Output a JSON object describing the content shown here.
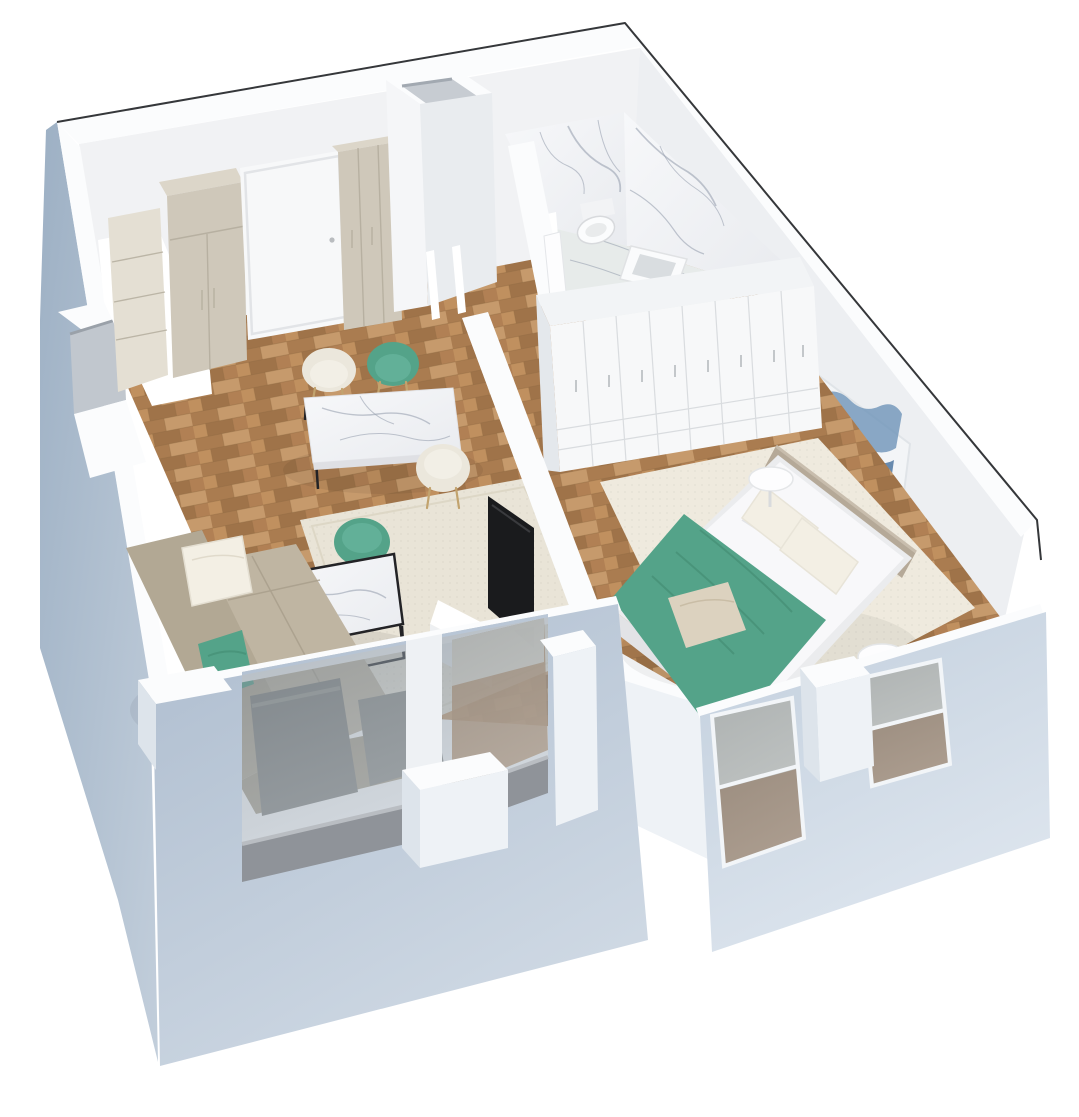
{
  "scene": {
    "title": "3D isometric cutaway floor plan of a one-bedroom apartment",
    "view": "bird's-eye axonometric render, walls cut open, exterior walls blue-grey",
    "rooms": [
      {
        "name": "living-dining-room",
        "floor": "wood-parquet",
        "items": [
          "beige-corner-sofa",
          "white-throw-pillow",
          "green-throw-pillow",
          "beige-area-rug",
          "marble-coffee-table-black-frame",
          "marble-dining-table",
          "green-dining-chair",
          "green-dining-chair-2",
          "beige-dining-chair",
          "beige-dining-chair-2",
          "tv-on-wall",
          "white-media-unit",
          "beige-kitchen-shelving",
          "beige-tall-cabinet",
          "beige-tall-cabinet-2",
          "white-entrance-door",
          "white-counter-block",
          "two-large-front-windows"
        ]
      },
      {
        "name": "hallway",
        "floor": "wood-parquet",
        "items": [
          "vent-shaft-column",
          "cased-door-opening"
        ]
      },
      {
        "name": "bathroom",
        "floor": "marble",
        "items": [
          "marble-back-wall",
          "marble-side-wall",
          "wall-hung-toilet",
          "square-countertop-basin",
          "bidet-edge",
          "bathroom-door"
        ]
      },
      {
        "name": "bedroom",
        "floor": "wood-parquet",
        "items": [
          "double-bed-white-bedding",
          "green-throw-blanket",
          "beige-fabric-headboard",
          "white-pillows",
          "beige-accent-pillow",
          "white-slim-door-wardrobe",
          "round-side-table",
          "round-side-table-2",
          "abstract-blue-gold-wall-art",
          "beige-area-rug",
          "two-framed-windows"
        ]
      }
    ],
    "palette": {
      "outline": "#35373a",
      "wall_top": "#fbfcfd",
      "wall_face": "#f1f2f4",
      "wall_face2": "#edeff2",
      "exterior_dark": "#9db0c4",
      "exterior": "#aebdcf",
      "exterior_light": "#cfd9e4",
      "facade_right": "#c2cfdd",
      "facade_right_light": "#dde5ee",
      "glass": "#8f9aa5",
      "sill": "#8f9399",
      "wood": "#b7895c",
      "wood_dark": "#9f7349",
      "wood_mid": "#aa7c50",
      "wood_light": "#c69a6c",
      "marble": "#f4f5f7",
      "marble_vein": "#9aa2b0",
      "bath_floor": "#e7ebea",
      "rug_living": "#e9e4d7",
      "rug_bedroom": "#efeade",
      "cabinet": "#cfc8ba",
      "cabinet_top": "#dcd6c9",
      "cabinet_seam": "#b2ab9b",
      "shelf": "#e4dfd3",
      "door_white": "#f7f8f9",
      "accent_green": "#54a389",
      "green_dark": "#458e75",
      "sofa": "#b2a894",
      "sofa_dark": "#a89e8a",
      "sofa_seat": "#bfb5a2",
      "pillow_white": "#f3efe4",
      "pillow_beige": "#dcd2bf",
      "bed_white": "#f8f8fa",
      "bed_frame": "#ebecee",
      "headboard": "#b5a998",
      "tv": "#1a1b1d",
      "metal": "#232326",
      "art_blue": "#6e93b8",
      "art_navy": "#3a6695",
      "art_gold": "#c9a24b",
      "step_face": "#eef2f6",
      "jamb_shade": "#dde4eb"
    }
  }
}
